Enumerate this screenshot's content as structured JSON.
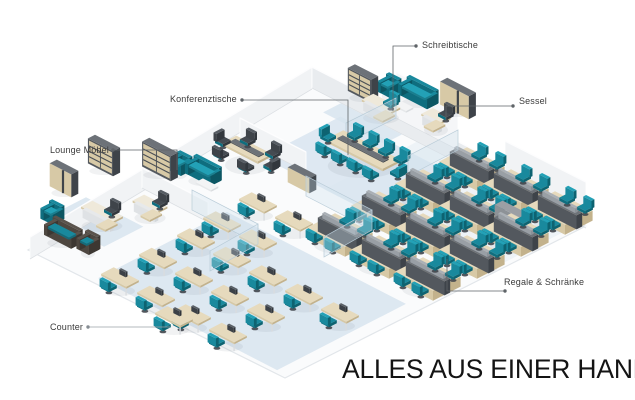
{
  "annotations": {
    "schreibtische": {
      "label": "Schreibtische"
    },
    "konferenztische": {
      "label": "Konferenztische"
    },
    "sessel": {
      "label": "Sessel"
    },
    "lounge_moebel": {
      "label": "Lounge Möbel"
    },
    "regale_schraenke": {
      "label": "Regale & Schränke"
    },
    "counter": {
      "label": "Counter"
    }
  },
  "tagline": {
    "text": "ALLES AUS EINER HAND!"
  },
  "colors": {
    "accent_teal": "#19899d",
    "accent_teal_bright": "#23a1b6",
    "accent_teal_dark": "#0f6e7f",
    "wood": "#e6dabd",
    "wood_front": "#d7c9a6",
    "wood_side": "#c3b28c",
    "furniture_gray_top": "#6d7278",
    "furniture_gray": "#53585e",
    "furniture_gray_dark": "#3e4349",
    "screen_gray": "#aab0b6",
    "sideboard_gray": "#8d9297",
    "lounge_brown": "#4e4740",
    "white_top": "#f4f5f6",
    "white_front": "#e9ebed",
    "white_side": "#dde0e3",
    "wall": "#f1f3f5",
    "wall_shaded": "#e9ecef",
    "floor": "#fafbfc",
    "floor_edge": "#e2e6ea",
    "carpet_blue": "#d7e4ef",
    "glass": "#cfe2ec",
    "label_text": "#3b3b3b",
    "connector": "#5f6468",
    "connector_light": "#9aa1a7",
    "tagline_text": "#141414"
  }
}
